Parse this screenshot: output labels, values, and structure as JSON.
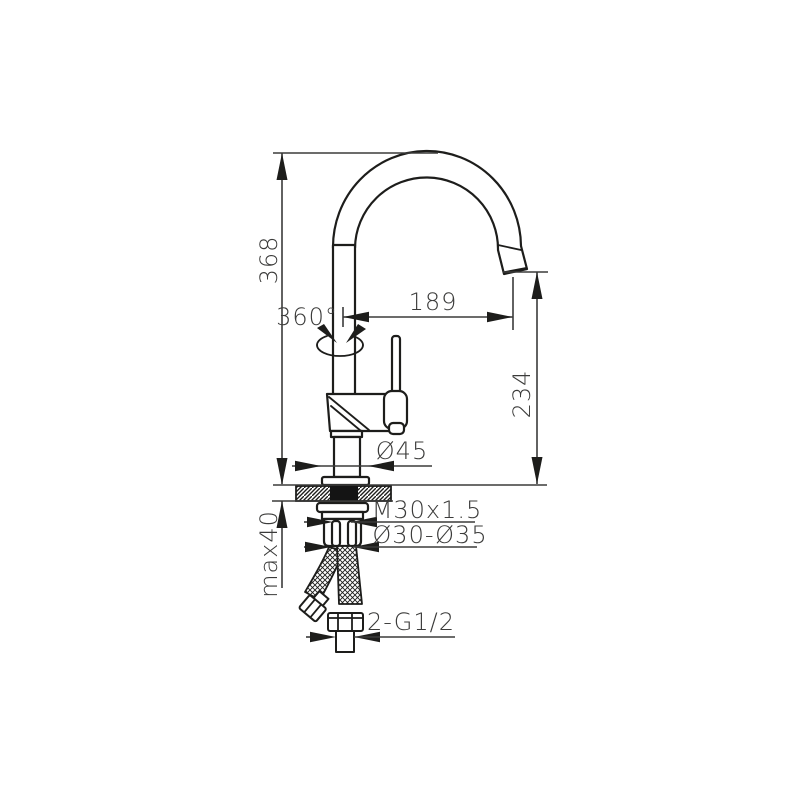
{
  "meta": {
    "type": "technical-dimension-drawing",
    "subject": "kitchen faucet with swivel gooseneck spout, installation dimensions in mm"
  },
  "colors": {
    "background": "#ffffff",
    "outline": "#1d1d1b",
    "dimension": "#3b3b3a",
    "shank_fill": "#141414"
  },
  "dimensions": {
    "total_height": "368",
    "swivel_angle": "360°",
    "spout_reach": "189",
    "spout_outlet_height": "234",
    "base_diameter": "Ø45",
    "mounting_thread": "M30x1.5",
    "mounting_hole_range": "Ø30-Ø35",
    "max_deck_thickness": "max40",
    "supply_connection": "2-G1/2"
  }
}
